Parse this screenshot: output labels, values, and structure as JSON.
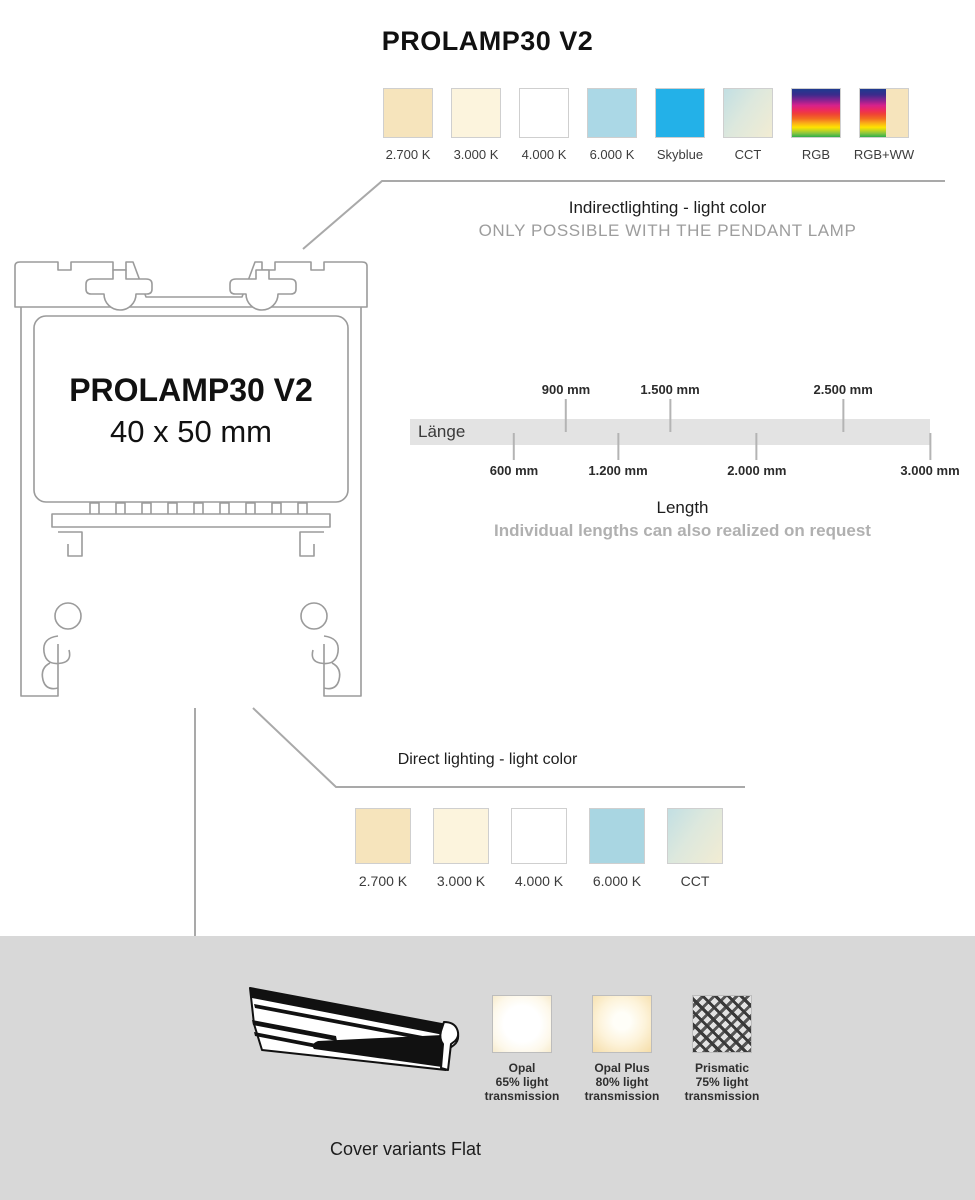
{
  "page": {
    "title": "PROLAMP30 V2",
    "background": "#ffffff",
    "section_background": "#d8d8d8",
    "line_color": "#a9a9a9"
  },
  "profile": {
    "name": "PROLAMP30 V2",
    "dimensions": "40 x 50 mm"
  },
  "indirect": {
    "heading": "Indirectlighting - light color",
    "subheading": "ONLY POSSIBLE WITH THE PENDANT LAMP",
    "swatches": [
      {
        "label": "2.700 K",
        "type": "solid",
        "color": "#f6e4bc"
      },
      {
        "label": "3.000 K",
        "type": "solid",
        "color": "#fcf4dd"
      },
      {
        "label": "4.000 K",
        "type": "solid",
        "color": "#ffffff"
      },
      {
        "label": "6.000 K",
        "type": "solid",
        "color": "#abd8e6"
      },
      {
        "label": "Skyblue",
        "type": "solid",
        "color": "#23b1e8"
      },
      {
        "label": "CCT",
        "type": "gradient-cct",
        "colors": [
          "#c2dfe3",
          "#f2ecd3"
        ]
      },
      {
        "label": "RGB",
        "type": "gradient-rgb",
        "colors": [
          "#1e3a8f",
          "#8c2390",
          "#ed2a5e",
          "#f9a61a",
          "#ffe400",
          "#2fae4a"
        ]
      },
      {
        "label": "RGB+WW",
        "type": "gradient-rgb-plus-warmwhite",
        "colors": [
          "#1e3a8f",
          "#ffe400",
          "#2fae4a",
          "#f6e4bc"
        ]
      }
    ]
  },
  "length_scale": {
    "bar_label": "Länge",
    "heading": "Length",
    "subheading": "Individual lengths can also realized on request",
    "ticks_above": [
      {
        "label": "900 mm",
        "left": "30%"
      },
      {
        "label": "1.500 mm",
        "left": "50%"
      },
      {
        "label": "2.500 mm",
        "left": "83.3%"
      }
    ],
    "ticks_below": [
      {
        "label": "600 mm",
        "left": "20%"
      },
      {
        "label": "1.200 mm",
        "left": "40%"
      },
      {
        "label": "2.000 mm",
        "left": "66.7%"
      },
      {
        "label": "3.000 mm",
        "left": "100%"
      }
    ]
  },
  "direct": {
    "heading": "Direct lighting - light color",
    "swatches": [
      {
        "label": "2.700 K",
        "type": "solid",
        "color": "#f6e4bc"
      },
      {
        "label": "3.000 K",
        "type": "solid",
        "color": "#fcf4dd"
      },
      {
        "label": "4.000 K",
        "type": "solid",
        "color": "#ffffff"
      },
      {
        "label": "6.000 K",
        "type": "solid",
        "color": "#a9d6e2"
      },
      {
        "label": "CCT",
        "type": "gradient-cct",
        "colors": [
          "#c2dfe3",
          "#f2ecd3"
        ]
      }
    ]
  },
  "covers": {
    "heading": "Cover variants Flat",
    "items": [
      {
        "name": "Opal",
        "line2": "65% light",
        "line3": "transmission",
        "type": "opal"
      },
      {
        "name": "Opal Plus",
        "line2": "80% light",
        "line3": "transmission",
        "type": "opal-plus"
      },
      {
        "name": "Prismatic",
        "line2": "75% light",
        "line3": "transmission",
        "type": "prismatic"
      }
    ]
  }
}
